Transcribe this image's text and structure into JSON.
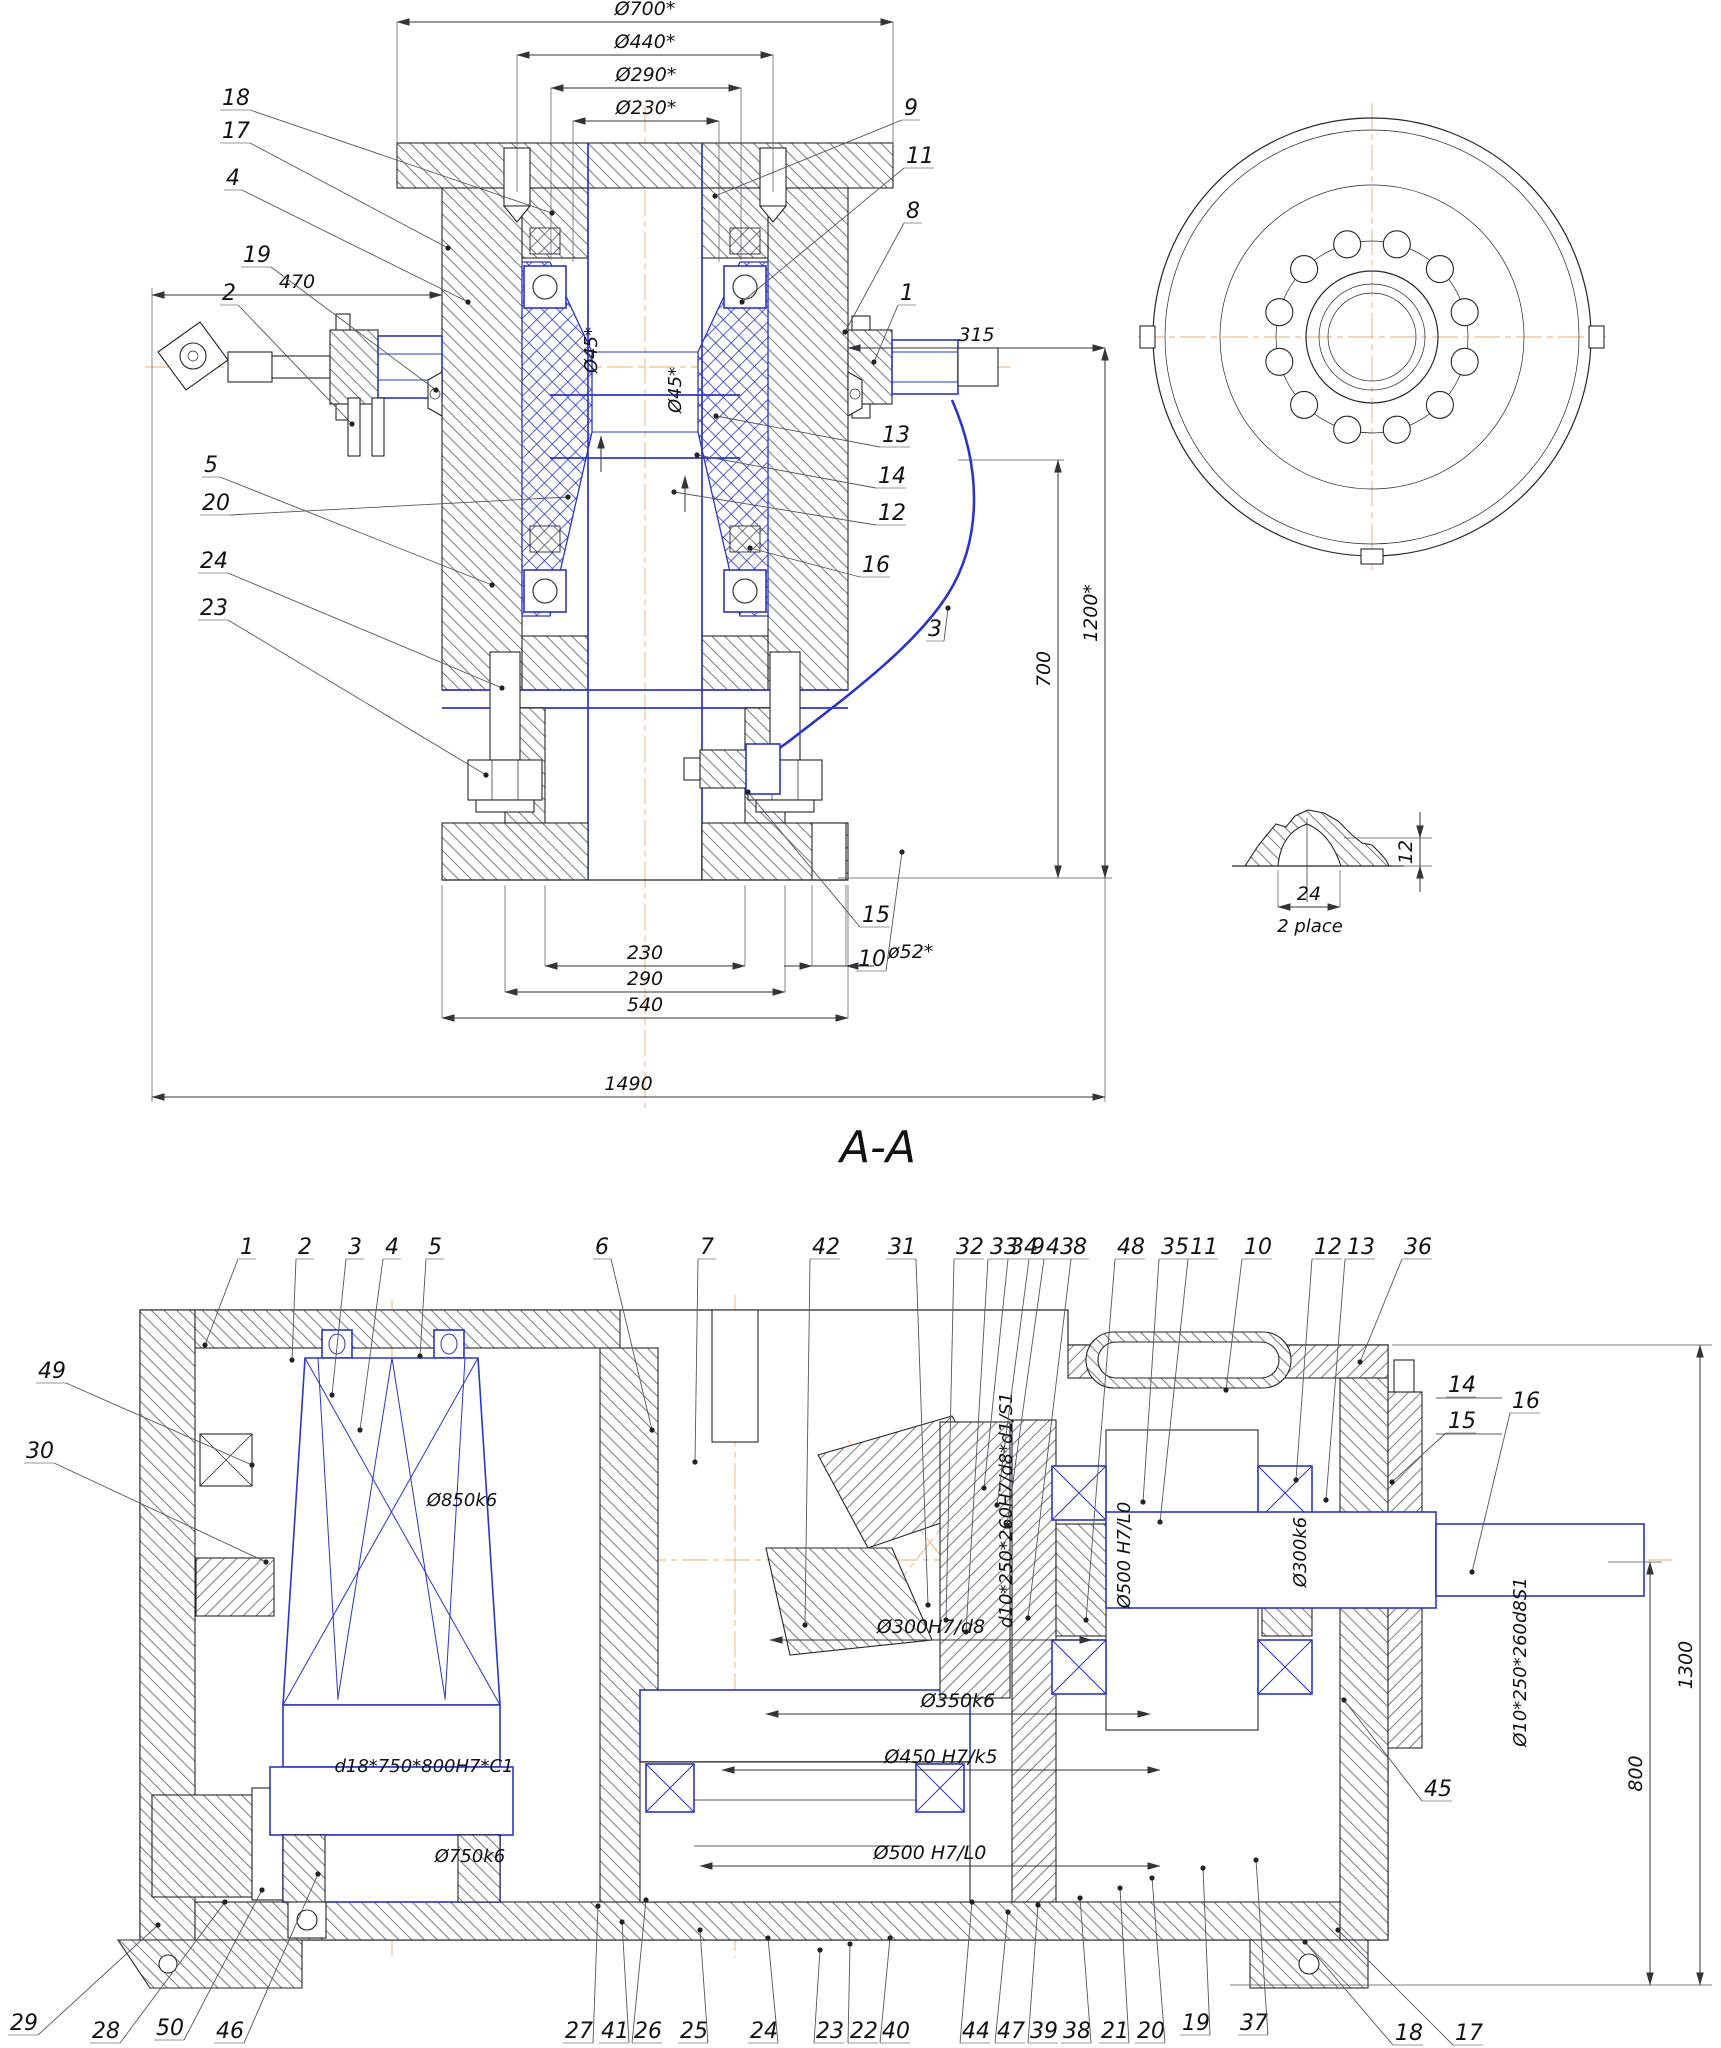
{
  "drawing": {
    "type": "mechanical-assembly-drawing",
    "colors": {
      "line": "#26262b",
      "accent": "#2b35c8",
      "centerline": "#efae72",
      "text": "#111111"
    }
  },
  "views": {
    "front": {
      "name": "main-sectional-view",
      "dims_h": [
        {
          "t": "Ø700*",
          "x1": 397,
          "x2": 893,
          "y": 22,
          "ey": 145
        },
        {
          "t": "Ø440*",
          "x1": 517,
          "x2": 773,
          "y": 55,
          "ey": 192
        },
        {
          "t": "Ø290*",
          "x1": 551,
          "x2": 741,
          "y": 88,
          "ey": 260
        },
        {
          "t": "Ø230*",
          "x1": 573,
          "x2": 719,
          "y": 121,
          "ey": 262
        },
        {
          "t": "470",
          "x1": 152,
          "x2": 442,
          "y": 295
        },
        {
          "t": "315",
          "x1": 848,
          "x2": 1105,
          "y": 348
        },
        {
          "t": "230",
          "x1": 545,
          "x2": 745,
          "y": 966,
          "ey": 885
        },
        {
          "t": "290",
          "x1": 505,
          "x2": 785,
          "y": 992,
          "ey": 885
        },
        {
          "t": "540",
          "x1": 442,
          "x2": 848,
          "y": 1018,
          "ey": 885
        },
        {
          "t": "ø52*",
          "x1": 812,
          "x2": 846,
          "y": 966,
          "out": true,
          "tx": 888,
          "ty": 958,
          "ey": 885
        },
        {
          "t": "1490",
          "x1": 152,
          "x2": 1105,
          "y": 1097
        }
      ],
      "dims_v": [
        {
          "t": "1200*",
          "x": 1105,
          "y1": 348,
          "y2": 878
        },
        {
          "t": "700",
          "x": 1058,
          "y1": 460,
          "y2": 878
        }
      ],
      "annos": [
        {
          "t": "Ø45*",
          "x": 597,
          "y": 350,
          "rot": -90
        },
        {
          "t": "Ø45*",
          "x": 681,
          "y": 390,
          "rot": -90
        }
      ],
      "callouts": [
        {
          "t": "18",
          "x": 222,
          "y": 105,
          "lx": 552,
          "ly": 213
        },
        {
          "t": "17",
          "x": 222,
          "y": 138,
          "lx": 448,
          "ly": 248
        },
        {
          "t": "4",
          "x": 226,
          "y": 185,
          "lx": 468,
          "ly": 302
        },
        {
          "t": "19",
          "x": 243,
          "y": 262,
          "lx": 436,
          "ly": 390
        },
        {
          "t": "2",
          "x": 222,
          "y": 300,
          "lx": 352,
          "ly": 424
        },
        {
          "t": "5",
          "x": 204,
          "y": 472,
          "lx": 492,
          "ly": 585
        },
        {
          "t": "20",
          "x": 202,
          "y": 510,
          "lx": 568,
          "ly": 497
        },
        {
          "t": "24",
          "x": 200,
          "y": 568,
          "lx": 502,
          "ly": 688
        },
        {
          "t": "23",
          "x": 200,
          "y": 615,
          "lx": 486,
          "ly": 775
        },
        {
          "t": "9",
          "x": 904,
          "y": 115,
          "lx": 715,
          "ly": 196
        },
        {
          "t": "11",
          "x": 906,
          "y": 163,
          "lx": 742,
          "ly": 302
        },
        {
          "t": "8",
          "x": 906,
          "y": 218,
          "lx": 845,
          "ly": 332
        },
        {
          "t": "1",
          "x": 900,
          "y": 300,
          "lx": 874,
          "ly": 362
        },
        {
          "t": "13",
          "x": 882,
          "y": 442,
          "lx": 716,
          "ly": 416
        },
        {
          "t": "14",
          "x": 878,
          "y": 483,
          "lx": 697,
          "ly": 455
        },
        {
          "t": "12",
          "x": 878,
          "y": 520,
          "lx": 674,
          "ly": 492
        },
        {
          "t": "16",
          "x": 862,
          "y": 572,
          "lx": 750,
          "ly": 548
        },
        {
          "t": "3",
          "x": 928,
          "y": 636,
          "lx": 948,
          "ly": 608
        },
        {
          "t": "15",
          "x": 862,
          "y": 922,
          "lx": 748,
          "ly": 792
        },
        {
          "t": "10",
          "x": 858,
          "y": 966,
          "lx": 902,
          "ly": 852
        }
      ]
    },
    "end": {
      "name": "end-view"
    },
    "detail": {
      "name": "lug-detail-view",
      "dims_h": [
        {
          "t": "24",
          "x1": 1278,
          "x2": 1340,
          "y": 907,
          "ey": 870
        }
      ],
      "dims_v": [
        {
          "t": "12",
          "x": 1420,
          "y1": 838,
          "y2": 866,
          "out": true,
          "tx": 1412,
          "ty": 852
        }
      ],
      "annos": [
        {
          "t": "2 place",
          "x": 1310,
          "y": 932
        }
      ]
    },
    "aa": {
      "name": "section-a-a",
      "title": "A-A",
      "dims_v": [
        {
          "t": "1300",
          "x": 1700,
          "y1": 1345,
          "y2": 1985
        },
        {
          "t": "800",
          "x": 1650,
          "y1": 1562,
          "y2": 1985
        }
      ],
      "dims_h": [
        {
          "t": "Ø300H7/d8",
          "x1": 770,
          "x2": 1092,
          "y": 1640
        },
        {
          "t": "Ø350k6",
          "x1": 766,
          "x2": 1150,
          "y": 1714
        },
        {
          "t": "Ø450 H7/k5",
          "x1": 722,
          "x2": 1160,
          "y": 1770
        },
        {
          "t": "Ø500 H7/L0",
          "x1": 700,
          "x2": 1160,
          "y": 1866
        }
      ],
      "annos": [
        {
          "t": "Ø850k6",
          "x": 462,
          "y": 1506
        },
        {
          "t": "d18*750*800H7*C1",
          "x": 424,
          "y": 1772
        },
        {
          "t": "Ø750k6",
          "x": 470,
          "y": 1862
        },
        {
          "t": "d10*250*260H7/d8*d1/S1",
          "x": 1012,
          "y": 1510,
          "rot": -90
        },
        {
          "t": "Ø500 H7/L0",
          "x": 1130,
          "y": 1555,
          "rot": -90
        },
        {
          "t": "Ø300k6",
          "x": 1306,
          "y": 1552,
          "rot": -90
        },
        {
          "t": "Ø10*250*260d8S1",
          "x": 1526,
          "y": 1662,
          "rot": -90
        }
      ],
      "callouts": [
        {
          "t": "1",
          "x": 240,
          "y": 1254,
          "lx": 205,
          "ly": 1345
        },
        {
          "t": "2",
          "x": 298,
          "y": 1254,
          "lx": 292,
          "ly": 1360
        },
        {
          "t": "3",
          "x": 348,
          "y": 1254,
          "lx": 332,
          "ly": 1395
        },
        {
          "t": "4",
          "x": 385,
          "y": 1254,
          "lx": 360,
          "ly": 1430
        },
        {
          "t": "5",
          "x": 428,
          "y": 1254,
          "lx": 420,
          "ly": 1356
        },
        {
          "t": "6",
          "x": 595,
          "y": 1254,
          "lx": 652,
          "ly": 1430
        },
        {
          "t": "7",
          "x": 700,
          "y": 1254,
          "lx": 695,
          "ly": 1462
        },
        {
          "t": "42",
          "x": 812,
          "y": 1254,
          "lx": 805,
          "ly": 1625
        },
        {
          "t": "31",
          "x": 888,
          "y": 1254,
          "lx": 928,
          "ly": 1605
        },
        {
          "t": "32",
          "x": 956,
          "y": 1254,
          "lx": 946,
          "ly": 1620
        },
        {
          "t": "33",
          "x": 990,
          "y": 1254,
          "lx": 966,
          "ly": 1632
        },
        {
          "t": "34",
          "x": 1010,
          "y": 1254,
          "lx": 984,
          "ly": 1488
        },
        {
          "t": "9",
          "x": 1031,
          "y": 1254,
          "lx": 997,
          "ly": 1505
        },
        {
          "t": "43",
          "x": 1046,
          "y": 1254,
          "lx": 1007,
          "ly": 1525
        },
        {
          "t": "8",
          "x": 1073,
          "y": 1254,
          "lx": 1028,
          "ly": 1618
        },
        {
          "t": "48",
          "x": 1117,
          "y": 1254,
          "lx": 1086,
          "ly": 1620
        },
        {
          "t": "35",
          "x": 1161,
          "y": 1254,
          "lx": 1143,
          "ly": 1502
        },
        {
          "t": "11",
          "x": 1190,
          "y": 1254,
          "lx": 1160,
          "ly": 1522
        },
        {
          "t": "10",
          "x": 1244,
          "y": 1254,
          "lx": 1226,
          "ly": 1390
        },
        {
          "t": "12",
          "x": 1314,
          "y": 1254,
          "lx": 1296,
          "ly": 1480
        },
        {
          "t": "13",
          "x": 1347,
          "y": 1254,
          "lx": 1326,
          "ly": 1500
        },
        {
          "t": "36",
          "x": 1404,
          "y": 1254,
          "lx": 1360,
          "ly": 1362
        },
        {
          "t": "14",
          "x": 1448,
          "y": 1392
        },
        {
          "t": "15",
          "x": 1448,
          "y": 1428,
          "lx": 1392,
          "ly": 1482
        },
        {
          "t": "16",
          "x": 1512,
          "y": 1408,
          "lx": 1472,
          "ly": 1572
        },
        {
          "t": "45",
          "x": 1424,
          "y": 1796,
          "lx": 1344,
          "ly": 1700
        },
        {
          "t": "49",
          "x": 38,
          "y": 1378,
          "lx": 252,
          "ly": 1465
        },
        {
          "t": "30",
          "x": 26,
          "y": 1458,
          "lx": 266,
          "ly": 1562
        },
        {
          "t": "29",
          "x": 10,
          "y": 2030,
          "lx": 158,
          "ly": 1925
        },
        {
          "t": "28",
          "x": 92,
          "y": 2038,
          "lx": 225,
          "ly": 1902
        },
        {
          "t": "50",
          "x": 156,
          "y": 2035,
          "lx": 262,
          "ly": 1890
        },
        {
          "t": "46",
          "x": 216,
          "y": 2038,
          "lx": 318,
          "ly": 1874
        },
        {
          "t": "27",
          "x": 565,
          "y": 2038,
          "lx": 598,
          "ly": 1906
        },
        {
          "t": "41",
          "x": 601,
          "y": 2038,
          "lx": 622,
          "ly": 1922
        },
        {
          "t": "26",
          "x": 634,
          "y": 2038,
          "lx": 646,
          "ly": 1900
        },
        {
          "t": "25",
          "x": 680,
          "y": 2038,
          "lx": 700,
          "ly": 1930
        },
        {
          "t": "24",
          "x": 750,
          "y": 2038,
          "lx": 768,
          "ly": 1938
        },
        {
          "t": "23",
          "x": 816,
          "y": 2038,
          "lx": 820,
          "ly": 1950
        },
        {
          "t": "22",
          "x": 850,
          "y": 2038,
          "lx": 850,
          "ly": 1944
        },
        {
          "t": "40",
          "x": 882,
          "y": 2038,
          "lx": 890,
          "ly": 1938
        },
        {
          "t": "44",
          "x": 962,
          "y": 2038,
          "lx": 972,
          "ly": 1902
        },
        {
          "t": "47",
          "x": 997,
          "y": 2038,
          "lx": 1008,
          "ly": 1912
        },
        {
          "t": "39",
          "x": 1030,
          "y": 2038,
          "lx": 1038,
          "ly": 1905
        },
        {
          "t": "38",
          "x": 1063,
          "y": 2038,
          "lx": 1080,
          "ly": 1898
        },
        {
          "t": "21",
          "x": 1101,
          "y": 2038,
          "lx": 1120,
          "ly": 1888
        },
        {
          "t": "20",
          "x": 1137,
          "y": 2038,
          "lx": 1152,
          "ly": 1878
        },
        {
          "t": "19",
          "x": 1182,
          "y": 2030,
          "lx": 1203,
          "ly": 1868
        },
        {
          "t": "37",
          "x": 1240,
          "y": 2030,
          "lx": 1256,
          "ly": 1860
        },
        {
          "t": "18",
          "x": 1395,
          "y": 2040,
          "lx": 1305,
          "ly": 1942
        },
        {
          "t": "17",
          "x": 1455,
          "y": 2040,
          "lx": 1338,
          "ly": 1930
        }
      ]
    }
  }
}
